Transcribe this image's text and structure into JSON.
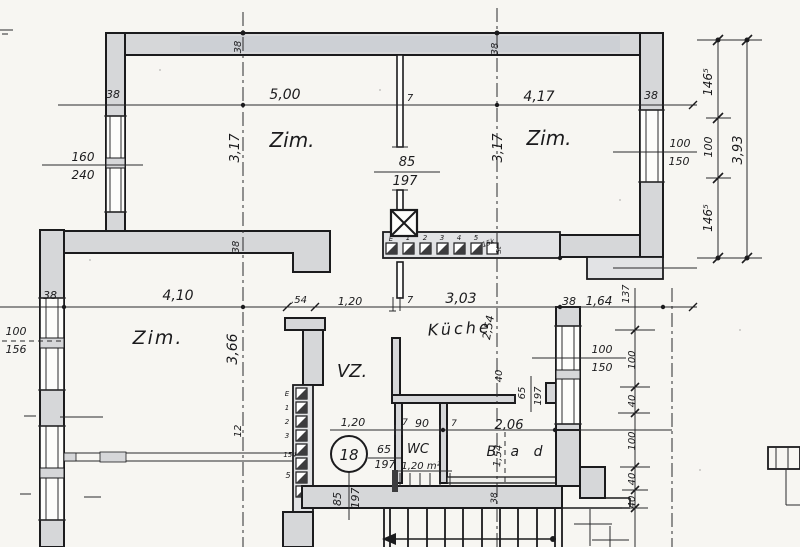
{
  "plan": {
    "unit_badge": "18",
    "colors": {
      "ink": "#1b1b1d",
      "wall_fill": "#d6d7d9",
      "band_fill": "#e2e3e5",
      "paper": "#f7f6f2",
      "smudge": "#c6cbd2"
    },
    "room_labels": [
      {
        "id": "room-zimmer-top-left",
        "t": "Zim.",
        "x": 292,
        "y": 147,
        "s": 20
      },
      {
        "id": "room-zimmer-top-right",
        "t": "Zim.",
        "x": 549,
        "y": 145,
        "s": 20
      },
      {
        "id": "room-zimmer-mid-left",
        "t": "Zim.",
        "x": 158,
        "y": 344,
        "s": 19,
        "sp": 2
      },
      {
        "id": "room-kueche",
        "t": "Küche",
        "x": 460,
        "y": 334,
        "s": 16,
        "sp": 3,
        "r": -3
      },
      {
        "id": "room-vz",
        "t": "VZ.",
        "x": 352,
        "y": 377,
        "s": 18
      },
      {
        "id": "room-wc",
        "t": "WC",
        "x": 418,
        "y": 453,
        "s": 13
      },
      {
        "id": "wc-area",
        "t": "1,20 m²",
        "x": 421,
        "y": 469,
        "s": 10
      },
      {
        "id": "room-bad",
        "t": "B a d",
        "x": 517,
        "y": 456,
        "s": 14,
        "sp": 5
      }
    ],
    "dimension_labels": [
      {
        "id": "dim-38-wall-left",
        "t": "38",
        "x": 113,
        "y": 98,
        "s": 11
      },
      {
        "id": "dim-5-00",
        "t": "5,00",
        "x": 285,
        "y": 99,
        "s": 14
      },
      {
        "id": "dim-7-top",
        "t": "7",
        "x": 410,
        "y": 101,
        "s": 10
      },
      {
        "id": "dim-4-17",
        "t": "4,17",
        "x": 539,
        "y": 101,
        "s": 14
      },
      {
        "id": "dim-38-wall-right",
        "t": "38",
        "x": 651,
        "y": 99,
        "s": 11
      },
      {
        "id": "dim-38-topwall-1",
        "t": "38",
        "x": 241,
        "y": 47,
        "s": 10,
        "r": -90
      },
      {
        "id": "dim-38-topwall-2",
        "t": "38",
        "x": 498,
        "y": 49,
        "s": 10,
        "r": -90
      },
      {
        "id": "dim-3-17-left",
        "t": "3,17",
        "x": 239,
        "y": 148,
        "s": 13,
        "r": -90
      },
      {
        "id": "dim-3-17-right",
        "t": "3,17",
        "x": 502,
        "y": 148,
        "s": 13,
        "r": -90
      },
      {
        "id": "win-160",
        "t": "160",
        "x": 83,
        "y": 161,
        "s": 12
      },
      {
        "id": "win-240",
        "t": "240",
        "x": 83,
        "y": 179,
        "s": 12
      },
      {
        "id": "door-85-top",
        "t": "85",
        "x": 407,
        "y": 166,
        "s": 13
      },
      {
        "id": "door-197-top",
        "t": "197",
        "x": 405,
        "y": 185,
        "s": 13
      },
      {
        "id": "win-100-tr",
        "t": "100",
        "x": 680,
        "y": 147,
        "s": 11
      },
      {
        "id": "win-150-tr",
        "t": "150",
        "x": 679,
        "y": 165,
        "s": 11
      },
      {
        "id": "chain-146-5-top",
        "t": "146⁵",
        "x": 712,
        "y": 82,
        "s": 12,
        "r": -90
      },
      {
        "id": "chain-100-right",
        "t": "100",
        "x": 712,
        "y": 147,
        "s": 11,
        "r": -90
      },
      {
        "id": "chain-146-5-bottom",
        "t": "146⁵",
        "x": 712,
        "y": 218,
        "s": 12,
        "r": -90
      },
      {
        "id": "chain-3-93",
        "t": "3,93",
        "x": 742,
        "y": 150,
        "s": 13,
        "r": -90
      },
      {
        "id": "dim-38-mid-left",
        "t": "38",
        "x": 50,
        "y": 299,
        "s": 11
      },
      {
        "id": "dim-4-10",
        "t": "4,10",
        "x": 178,
        "y": 300,
        "s": 14
      },
      {
        "id": "dim-54",
        "t": ",54",
        "x": 299,
        "y": 303,
        "s": 10
      },
      {
        "id": "dim-1-20-mid",
        "t": "1,20",
        "x": 350,
        "y": 305,
        "s": 11
      },
      {
        "id": "dim-7-mid",
        "t": "7",
        "x": 410,
        "y": 303,
        "s": 10
      },
      {
        "id": "dim-3-03",
        "t": "3,03",
        "x": 461,
        "y": 303,
        "s": 14
      },
      {
        "id": "dim-2-54",
        "t": "2,54",
        "x": 492,
        "y": 328,
        "s": 11,
        "r": -80
      },
      {
        "id": "dim-38-mid-right",
        "t": "38",
        "x": 569,
        "y": 305,
        "s": 11
      },
      {
        "id": "dim-1-64",
        "t": "1,64",
        "x": 599,
        "y": 305,
        "s": 12
      },
      {
        "id": "dim-137",
        "t": "137",
        "x": 629,
        "y": 294,
        "s": 10,
        "r": -90
      },
      {
        "id": "dim-3-66",
        "t": "3,66",
        "x": 237,
        "y": 349,
        "s": 14,
        "r": -90
      },
      {
        "id": "dim-12",
        "t": "12",
        "x": 241,
        "y": 431,
        "s": 10,
        "r": -90
      },
      {
        "id": "win-100-mr",
        "t": "100",
        "x": 602,
        "y": 353,
        "s": 11
      },
      {
        "id": "win-150-mr",
        "t": "150",
        "x": 602,
        "y": 371,
        "s": 11
      },
      {
        "id": "chain-100-a",
        "t": "100",
        "x": 635,
        "y": 360,
        "s": 10,
        "r": -90
      },
      {
        "id": "chain-40-a",
        "t": "40",
        "x": 635,
        "y": 401,
        "s": 10,
        "r": -90
      },
      {
        "id": "chain-100-b",
        "t": "100",
        "x": 635,
        "y": 441,
        "s": 10,
        "r": -90
      },
      {
        "id": "chain-40-b",
        "t": "40",
        "x": 635,
        "y": 479,
        "s": 10,
        "r": -90
      },
      {
        "id": "chain-40-c",
        "t": "40",
        "x": 635,
        "y": 502,
        "s": 10,
        "r": -90
      },
      {
        "id": "dim-40-stub",
        "t": "40",
        "x": 502,
        "y": 376,
        "s": 10,
        "r": -90
      },
      {
        "id": "door-65-kueche",
        "t": "65",
        "x": 525,
        "y": 393,
        "s": 10,
        "r": -90
      },
      {
        "id": "door-197-kueche",
        "t": "197",
        "x": 541,
        "y": 396,
        "s": 10,
        "r": -90
      },
      {
        "id": "dim-1-20-wc",
        "t": "1,20",
        "x": 353,
        "y": 426,
        "s": 11
      },
      {
        "id": "dim-7-wc-a",
        "t": "7",
        "x": 405,
        "y": 425,
        "s": 9
      },
      {
        "id": "dim-90-wc",
        "t": "90",
        "x": 422,
        "y": 427,
        "s": 11
      },
      {
        "id": "dim-7-wc-b",
        "t": "7",
        "x": 454,
        "y": 426,
        "s": 9
      },
      {
        "id": "dim-2-06",
        "t": "2,06",
        "x": 509,
        "y": 429,
        "s": 13
      },
      {
        "id": "dim-1-54",
        "t": "1,54",
        "x": 501,
        "y": 456,
        "s": 10,
        "r": -85
      },
      {
        "id": "door-65-wc",
        "t": "65",
        "x": 384,
        "y": 453,
        "s": 11
      },
      {
        "id": "door-197-wc",
        "t": "197",
        "x": 385,
        "y": 468,
        "s": 11
      },
      {
        "id": "door-85-entry",
        "t": "85",
        "x": 341,
        "y": 499,
        "s": 11,
        "r": -90
      },
      {
        "id": "door-197-entry",
        "t": "197",
        "x": 359,
        "y": 498,
        "s": 11,
        "r": -90
      },
      {
        "id": "dim-38-stair",
        "t": "38",
        "x": 497,
        "y": 498,
        "s": 9,
        "r": -90
      },
      {
        "id": "dim-38-band-left",
        "t": "38",
        "x": 239,
        "y": 247,
        "s": 10,
        "r": -90
      },
      {
        "id": "win-100-left",
        "t": "100",
        "x": 16,
        "y": 335,
        "s": 11
      },
      {
        "id": "win-156-left",
        "t": "156",
        "x": 16,
        "y": 353,
        "s": 11
      }
    ],
    "closet_labels": [
      {
        "id": "closet-h-E",
        "t": "E",
        "x": 391,
        "y": 241,
        "s": 7
      },
      {
        "id": "closet-h-1",
        "t": "1",
        "x": 408,
        "y": 240,
        "s": 7
      },
      {
        "id": "closet-h-2",
        "t": "2",
        "x": 425,
        "y": 240,
        "s": 7
      },
      {
        "id": "closet-h-3",
        "t": "3",
        "x": 442,
        "y": 240,
        "s": 7
      },
      {
        "id": "closet-h-4",
        "t": "4",
        "x": 459,
        "y": 240,
        "s": 7
      },
      {
        "id": "closet-h-5",
        "t": "5",
        "x": 476,
        "y": 240,
        "s": 7
      },
      {
        "id": "closet-h-15k",
        "t": "15k",
        "x": 489,
        "y": 245,
        "s": 7,
        "r": -20
      },
      {
        "id": "closet-h-st",
        "t": "St",
        "x": 501,
        "y": 250,
        "s": 7,
        "r": -90
      },
      {
        "id": "closet-v-E",
        "t": "E",
        "x": 287,
        "y": 396,
        "s": 7
      },
      {
        "id": "closet-v-1",
        "t": "1",
        "x": 287,
        "y": 410,
        "s": 7
      },
      {
        "id": "closet-v-2",
        "t": "2",
        "x": 287,
        "y": 424,
        "s": 7
      },
      {
        "id": "closet-v-3",
        "t": "3",
        "x": 287,
        "y": 438,
        "s": 7
      },
      {
        "id": "closet-v-154",
        "t": "154",
        "x": 290,
        "y": 457,
        "s": 7
      },
      {
        "id": "closet-v-5",
        "t": "5",
        "x": 288,
        "y": 478,
        "s": 8
      }
    ]
  }
}
